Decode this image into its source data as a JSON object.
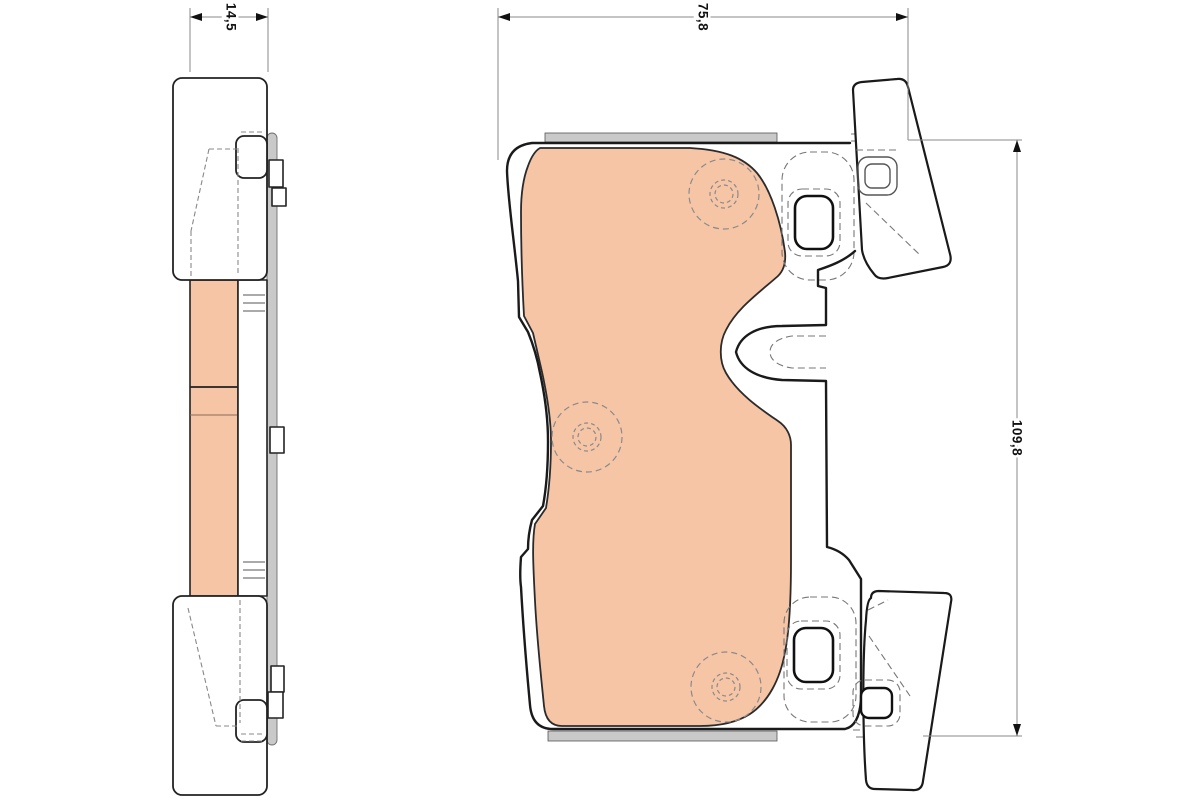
{
  "title": "brake-pad-technical-drawing",
  "drawing": {
    "background": "#ffffff",
    "outline_color": "#1a1a1a",
    "hidden_line_color": "#777777",
    "dimension_line_color": "#8a8a8a",
    "text_color": "#111111",
    "friction_fill": "#f6c5a6",
    "shim_fill": "#c9c9c9",
    "views": {
      "side_view": "side profile of brake pad",
      "front_view": "front view of brake pad with retainer ears"
    },
    "dimensions": {
      "thickness_mm": "14,5",
      "width_mm": "75,8",
      "height_mm": "109,8"
    }
  }
}
